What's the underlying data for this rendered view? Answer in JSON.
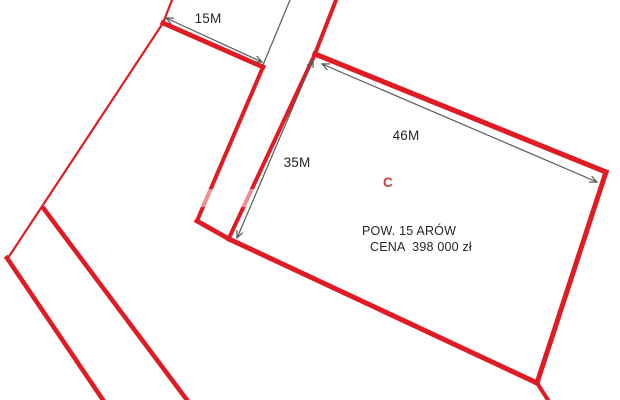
{
  "diagram": {
    "canvas": {
      "width": 620,
      "height": 400,
      "background": "#ffffff"
    },
    "colors": {
      "boundary_red": "#e01b24",
      "measure_line": "#5a5a5a",
      "parcel_line": "#666666",
      "text_dark": "#262626",
      "plot_label_red": "#d04040",
      "watermark_white": "#ffffff"
    },
    "red_lines": [
      {
        "name": "left-boundary-top-stub",
        "x1": 172,
        "y1": 0,
        "x2": 163,
        "y2": 23,
        "w": 2.2
      },
      {
        "name": "left-boundary-line",
        "x1": 163,
        "y1": 23,
        "x2": 8,
        "y2": 258,
        "w": 2.2
      },
      {
        "name": "lower-strip-left-line",
        "x1": 7,
        "y1": 258,
        "x2": 103,
        "y2": 400,
        "w": 4.6
      },
      {
        "name": "lower-strip-right-line",
        "x1": 44,
        "y1": 209,
        "x2": 187,
        "y2": 400,
        "w": 4.6
      },
      {
        "name": "front-15m-side",
        "x1": 163,
        "y1": 23,
        "x2": 263,
        "y2": 67,
        "w": 4.8
      },
      {
        "name": "street-left-line",
        "x1": 263,
        "y1": 67,
        "x2": 197,
        "y2": 221,
        "w": 4.0
      },
      {
        "name": "street-end-segment",
        "x1": 197,
        "y1": 221,
        "x2": 229,
        "y2": 239,
        "w": 4.8
      },
      {
        "name": "plot-c-bottom-edge",
        "x1": 229,
        "y1": 239,
        "x2": 537,
        "y2": 383,
        "w": 5.0
      },
      {
        "name": "boundary-continuation",
        "x1": 537,
        "y1": 383,
        "x2": 548,
        "y2": 400,
        "w": 4.0
      },
      {
        "name": "plot-c-right-edge",
        "x1": 606,
        "y1": 172,
        "x2": 537,
        "y2": 383,
        "w": 5.0
      },
      {
        "name": "plot-c-top-edge",
        "x1": 315,
        "y1": 54,
        "x2": 606,
        "y2": 172,
        "w": 5.2
      },
      {
        "name": "plot-c-left-edge",
        "x1": 315,
        "y1": 54,
        "x2": 229,
        "y2": 238,
        "w": 4.0
      },
      {
        "name": "top-boundary-stub",
        "x1": 336,
        "y1": 0,
        "x2": 315,
        "y2": 54,
        "w": 4.0
      }
    ],
    "thin_lines": [
      {
        "name": "parcel-boundary-line",
        "x1": 290,
        "y1": 0,
        "x2": 263,
        "y2": 65,
        "w": 1.3
      }
    ],
    "watermark_band": {
      "x": 143,
      "y": 189,
      "width": 125,
      "height": 18,
      "opacity": 0.5
    }
  },
  "measurements": [
    {
      "id": "15m",
      "label": "15M",
      "arrow": {
        "x1": 166,
        "y1": 18,
        "x2": 262,
        "y2": 62
      }
    },
    {
      "id": "35m",
      "label": "35M",
      "arrow": {
        "x1": 313,
        "y1": 60,
        "x2": 237,
        "y2": 238
      }
    },
    {
      "id": "46m",
      "label": "46M",
      "arrow": {
        "x1": 322,
        "y1": 64,
        "x2": 597,
        "y2": 182
      }
    }
  ],
  "plot": {
    "name": "C",
    "area": "POW. 15 ARÓW",
    "price": "CENA  398 000 zł"
  }
}
